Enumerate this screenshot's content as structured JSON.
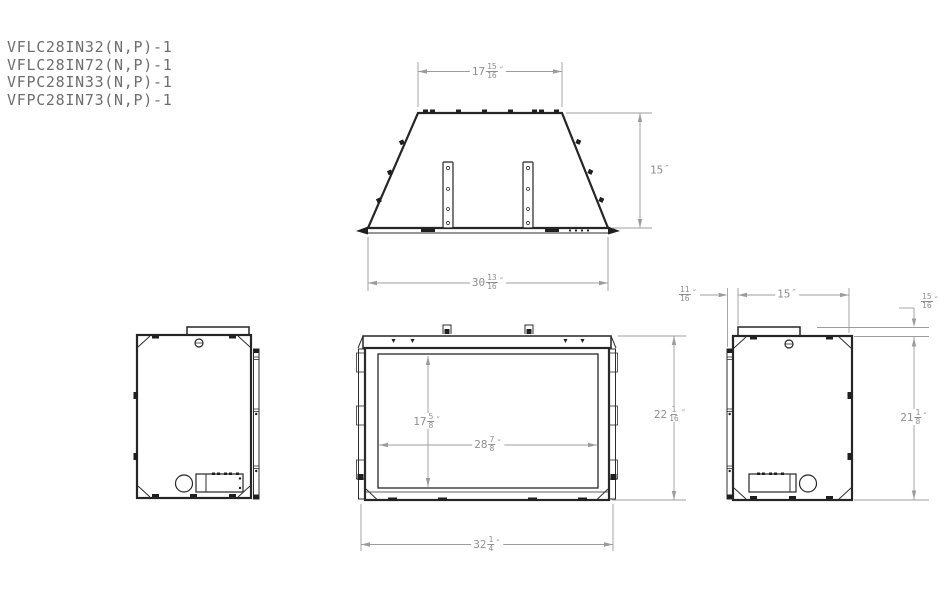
{
  "models": [
    "VFLC28IN32(N,P)-1",
    "VFLC28IN72(N,P)-1",
    "VFPC28IN33(N,P)-1",
    "VFPC28IN73(N,P)-1"
  ],
  "dims": {
    "top_width": {
      "whole": "17",
      "num": "15",
      "den": "16",
      "unit": "″"
    },
    "top_depth": {
      "whole": "15",
      "unit": "″"
    },
    "base_width": {
      "whole": "30",
      "num": "13",
      "den": "16",
      "unit": "″"
    },
    "opening_height": {
      "whole": "17",
      "num": "5",
      "den": "8",
      "unit": "″"
    },
    "opening_width": {
      "whole": "28",
      "num": "7",
      "den": "8",
      "unit": "″"
    },
    "overall_width": {
      "whole": "32",
      "num": "1",
      "den": "4",
      "unit": "″"
    },
    "overall_height": {
      "whole": "22",
      "num": "1",
      "den": "16",
      "unit": "″"
    },
    "flange_offset": {
      "num": "11",
      "den": "16",
      "unit": "″"
    },
    "body_depth": {
      "whole": "15",
      "unit": "″"
    },
    "top_flange_height": {
      "num": "15",
      "den": "16",
      "unit": "″"
    },
    "body_height": {
      "whole": "21",
      "num": "1",
      "den": "8",
      "unit": "″"
    }
  },
  "colors": {
    "line": "#262626",
    "dim": "#9c9c9c",
    "text": "#6e6e6e"
  }
}
